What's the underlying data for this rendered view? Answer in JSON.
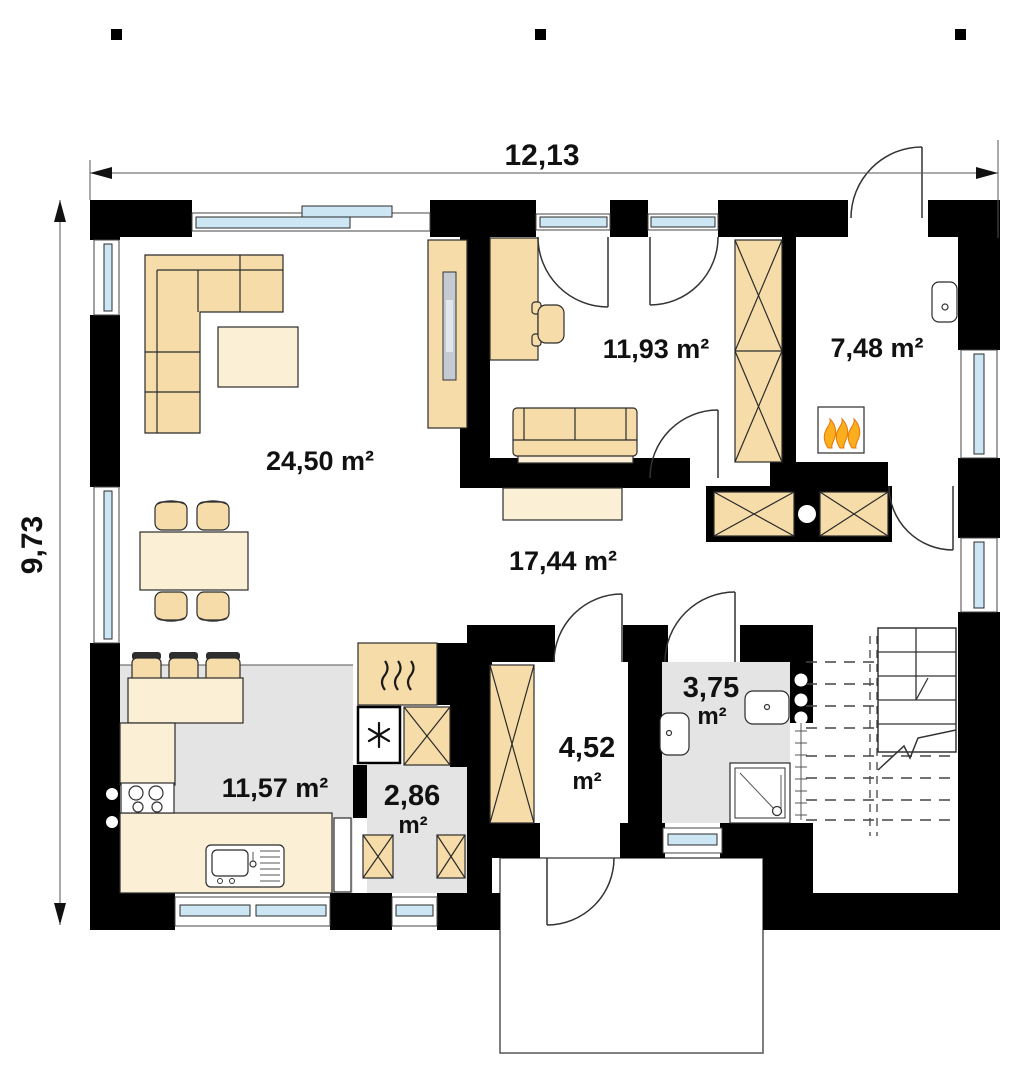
{
  "dimensions": {
    "width": "12,13",
    "height": "9,73"
  },
  "rooms": {
    "living": {
      "label": "24,50 m²"
    },
    "bedroom": {
      "label": "11,93 m²"
    },
    "boiler": {
      "label": "7,48 m²"
    },
    "hall": {
      "label": "17,44 m²"
    },
    "kitchen": {
      "label": "11,57 m²"
    },
    "pantry": {
      "value": "2,86",
      "unit": "m²"
    },
    "entry": {
      "value": "4,52",
      "unit": "m²"
    },
    "bathroom": {
      "value": "3,75",
      "unit": "m²"
    }
  },
  "colors": {
    "wall": "#000000",
    "furniture": "#F6DCA9",
    "furniture_light": "#FBEFD6",
    "window_glass": "#CDE6F4",
    "tile_floor": "#E4E4E4",
    "flame": "#FBAF1D"
  }
}
